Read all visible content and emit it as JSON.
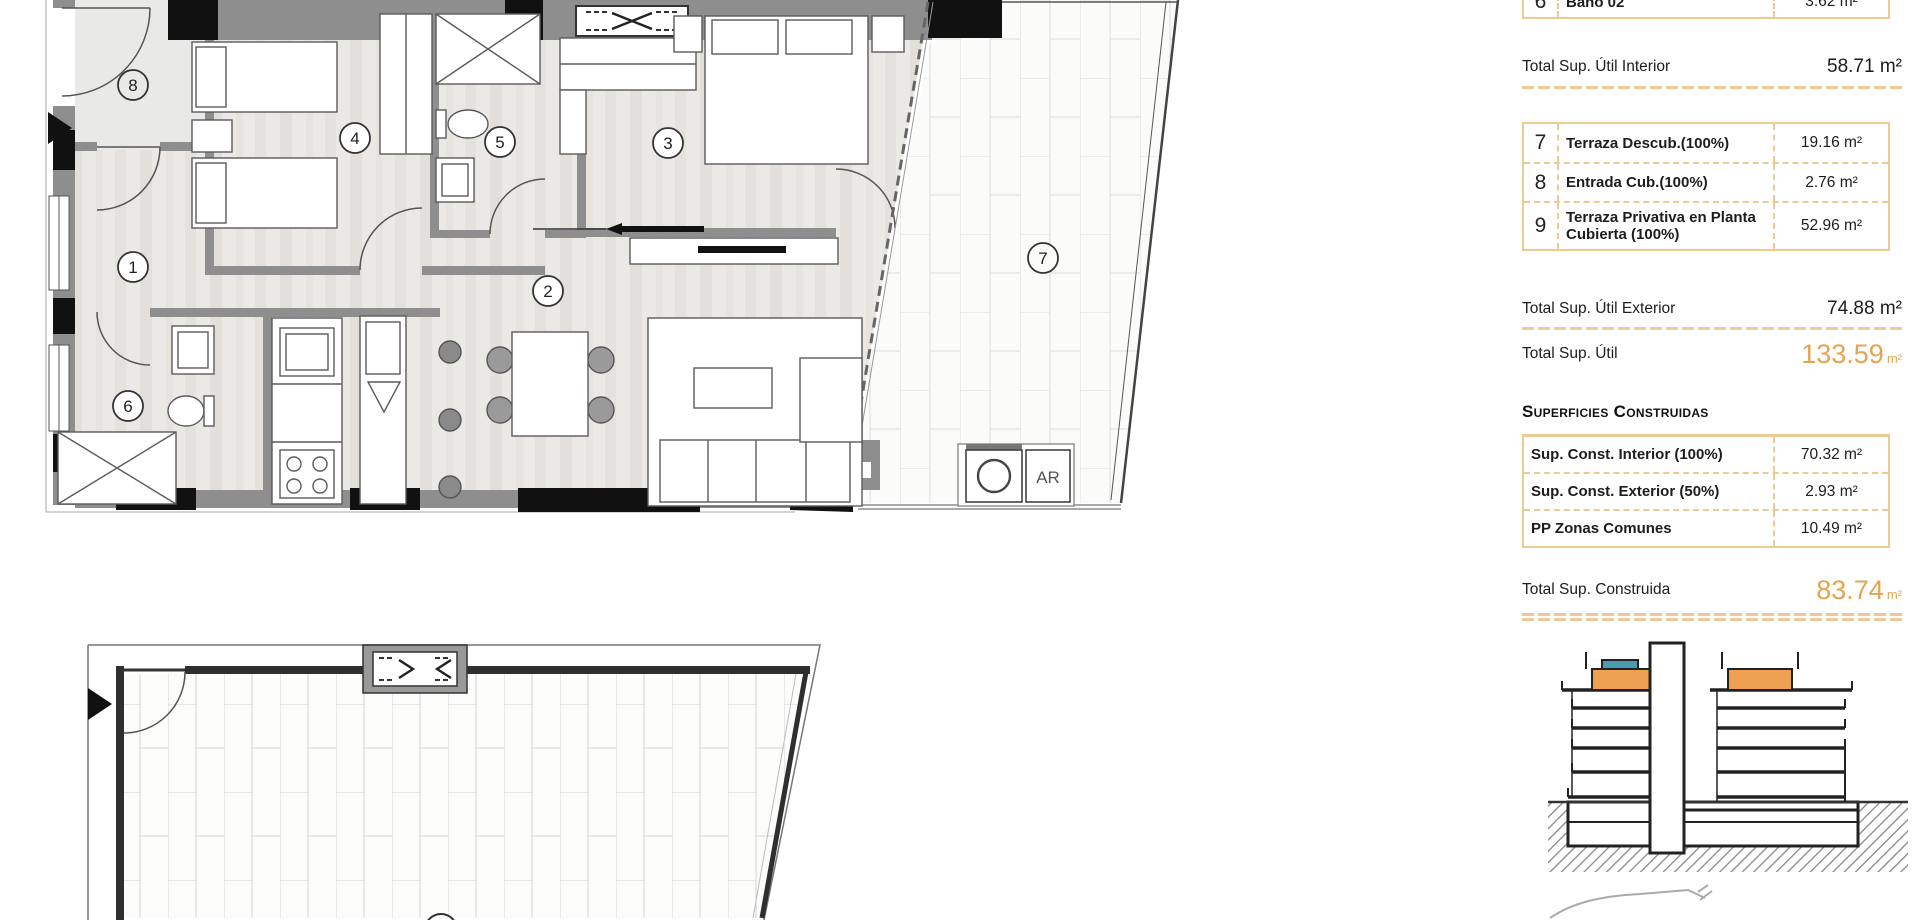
{
  "panel": {
    "partial_row": {
      "num": "6",
      "label": "Baño 02",
      "value": "3.62 m²"
    },
    "totals": {
      "util_interior": {
        "label": "Total Sup. Útil Interior",
        "value": "58.71 m²"
      },
      "util_exterior": {
        "label": "Total Sup. Útil Exterior",
        "value": "74.88 m²"
      },
      "util_total": {
        "label": "Total Sup. Útil",
        "value": "133.59",
        "unit": "m²"
      },
      "construida_total": {
        "label": "Total Sup. Construida",
        "value": "83.74",
        "unit": "m²"
      }
    },
    "exterior_rows": [
      {
        "num": "7",
        "label": "Terraza Descub.(100%)",
        "value": "19.16 m²"
      },
      {
        "num": "8",
        "label": "Entrada Cub.(100%)",
        "value": "2.76 m²"
      },
      {
        "num": "9",
        "label": "Terraza Privativa en Planta Cubierta (100%)",
        "value": "52.96 m²"
      }
    ],
    "construidas_header": "Superficies Construidas",
    "construidas_rows": [
      {
        "label": "Sup. Const. Interior (100%)",
        "value": "70.32 m²"
      },
      {
        "label": "Sup. Const. Exterior (50%)",
        "value": "2.93 m²"
      },
      {
        "label": "PP Zonas Comunes",
        "value": "10.49 m²"
      }
    ]
  },
  "plan": {
    "room_numbers": [
      "1",
      "2",
      "3",
      "4",
      "5",
      "6",
      "7",
      "8"
    ],
    "roof_terrace_number": "9",
    "laundry_label": "AR"
  },
  "colors": {
    "accent_orange": "#e4a452",
    "table_border": "#ecca93",
    "wall_gray": "#8e8e8e"
  }
}
